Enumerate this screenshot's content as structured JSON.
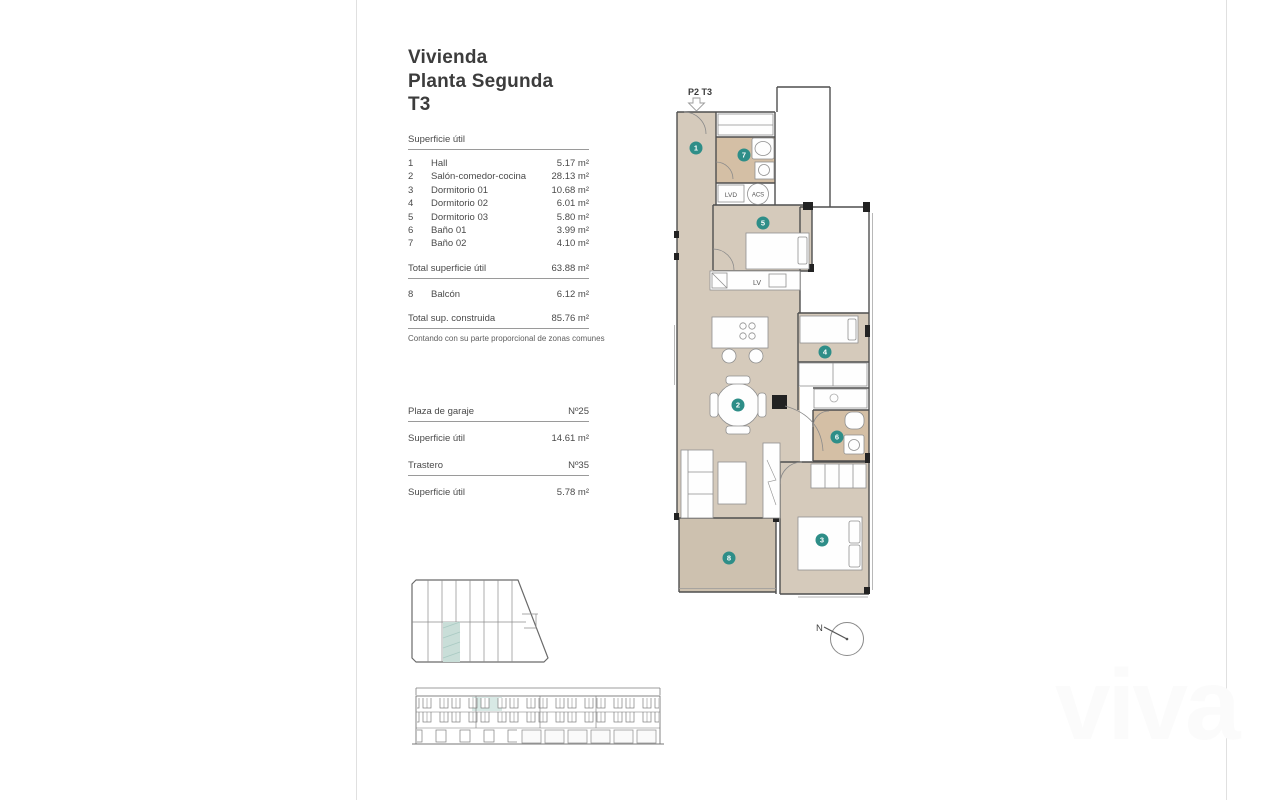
{
  "title": {
    "lines": [
      "Vivienda",
      "Planta Segunda",
      "T3"
    ]
  },
  "surface_table": {
    "header": "Superficie útil",
    "rows": [
      {
        "num": "1",
        "name": "Hall",
        "value": "5.17 m²"
      },
      {
        "num": "2",
        "name": "Salón-comedor-cocina",
        "value": "28.13 m²"
      },
      {
        "num": "3",
        "name": "Dormitorio 01",
        "value": "10.68 m²"
      },
      {
        "num": "4",
        "name": "Dormitorio 02",
        "value": "6.01 m²"
      },
      {
        "num": "5",
        "name": "Dormitorio 03",
        "value": "5.80 m²"
      },
      {
        "num": "6",
        "name": "Baño 01",
        "value": "3.99 m²"
      },
      {
        "num": "7",
        "name": "Baño 02",
        "value": "4.10 m²"
      }
    ],
    "total_label": "Total superficie útil",
    "total_value": "63.88 m²",
    "balcony_row": {
      "num": "8",
      "name": "Balcón",
      "value": "6.12 m²"
    },
    "built_label": "Total sup. construida",
    "built_value": "85.76 m²",
    "note": "Contando con su parte proporcional de zonas comunes"
  },
  "garage": {
    "label": "Plaza de garaje",
    "number": "Nº25",
    "area_label": "Superficie útil",
    "area_value": "14.61 m²"
  },
  "storage": {
    "label": "Trastero",
    "number": "Nº35",
    "area_label": "Superficie útil",
    "area_value": "5.78 m²"
  },
  "plan": {
    "label": "P2 T3",
    "markers": [
      "1",
      "2",
      "3",
      "4",
      "5",
      "6",
      "7",
      "8"
    ],
    "annotations": {
      "lvd": "LVD",
      "acs": "ACS",
      "lv": "LV"
    }
  },
  "compass": {
    "label": "N"
  },
  "watermark": {
    "text": "viva"
  },
  "colors": {
    "marker_teal": "#2e8e88",
    "floor": "#d5cabb",
    "bath_floor": "#d4bfa5",
    "balcony_floor": "#cdc1af",
    "site_highlight": "#c9ded8",
    "elevation_highlight": "#d8e9e5",
    "wall": "#4f4f4f"
  }
}
